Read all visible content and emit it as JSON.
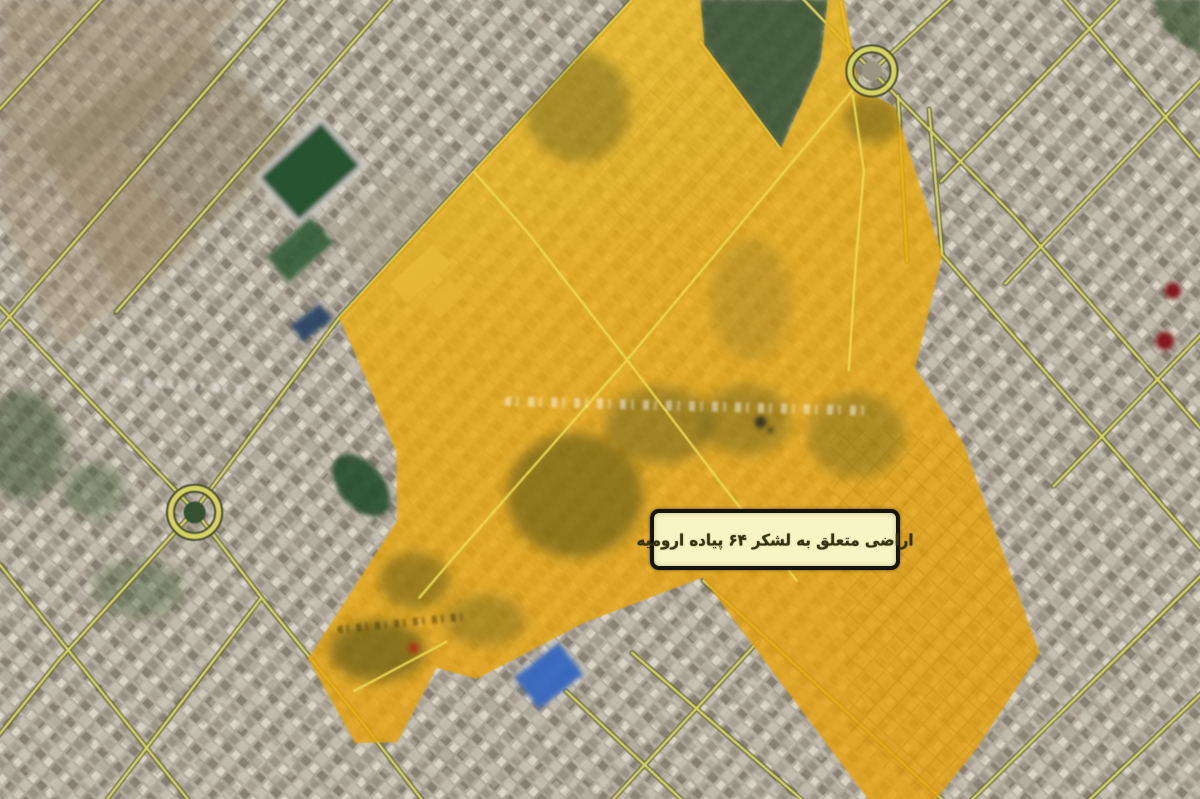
{
  "map": {
    "kind": "satellite-aerial-photo",
    "label_text": "اراضی متعلق به لشکر ۶۴ پیاده ارومیه",
    "label_style": {
      "background": "#F8F4C4",
      "border": "#15150F",
      "text_color": "#35320F"
    },
    "overlay_region": {
      "name": "highlighted-military-land-parcel",
      "fill": "#EEAB07",
      "opacity": 0.8
    },
    "road_color": "#D8D95E",
    "markers": {
      "red_dots": [
        {
          "x": 1171,
          "y": 291
        },
        {
          "x": 1163,
          "y": 341
        },
        {
          "x": 414,
          "y": 647
        }
      ],
      "blue_roof_buildings": [
        {
          "x": 549,
          "y": 675
        },
        {
          "x": 312,
          "y": 323
        }
      ],
      "roundabouts": [
        {
          "x": 196,
          "y": 512
        },
        {
          "x": 871,
          "y": 72
        }
      ]
    }
  }
}
